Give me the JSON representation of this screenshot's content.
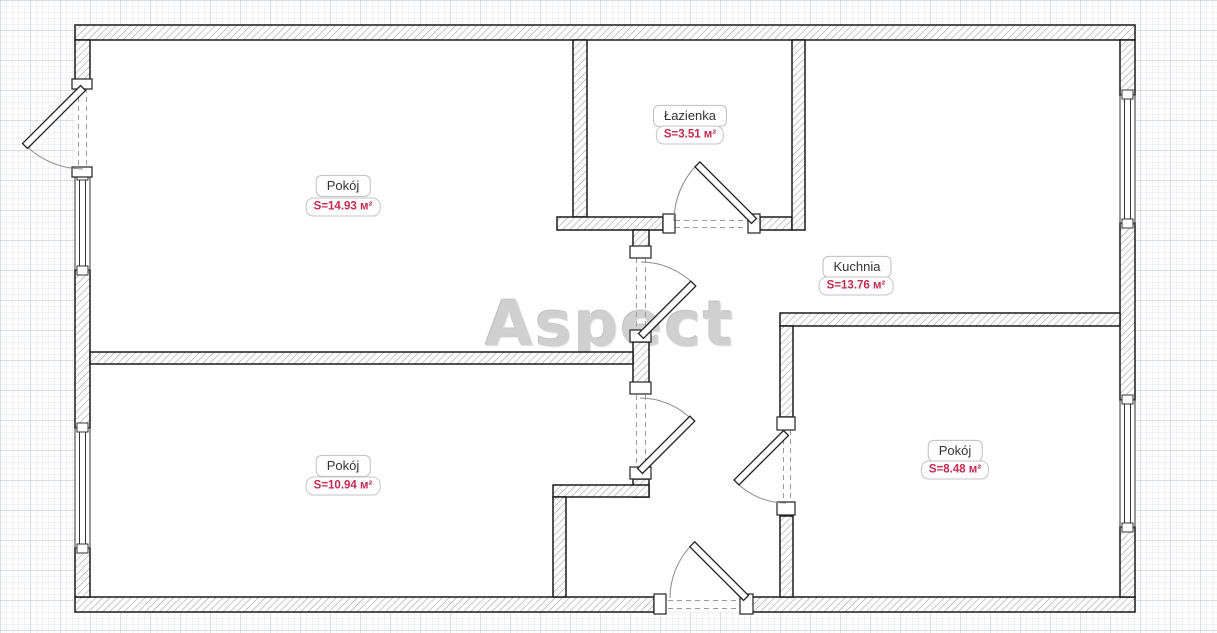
{
  "watermark": "Aspect",
  "rooms": [
    {
      "name": "Pokój",
      "area": "S=14.93 м²"
    },
    {
      "name": "Łazienka",
      "area": "S=3.51 м²"
    },
    {
      "name": "Kuchnia",
      "area": "S=13.76 м²"
    },
    {
      "name": "Pokój",
      "area": "S=10.94 м²"
    },
    {
      "name": "Pokój",
      "area": "S=8.48 м²"
    }
  ],
  "colors": {
    "area_text": "#c42b50",
    "room_text": "#333333",
    "wall_outline": "#1a1a1a",
    "watermark": "#d0d0d0",
    "grid_line": "#c3c9d0"
  }
}
